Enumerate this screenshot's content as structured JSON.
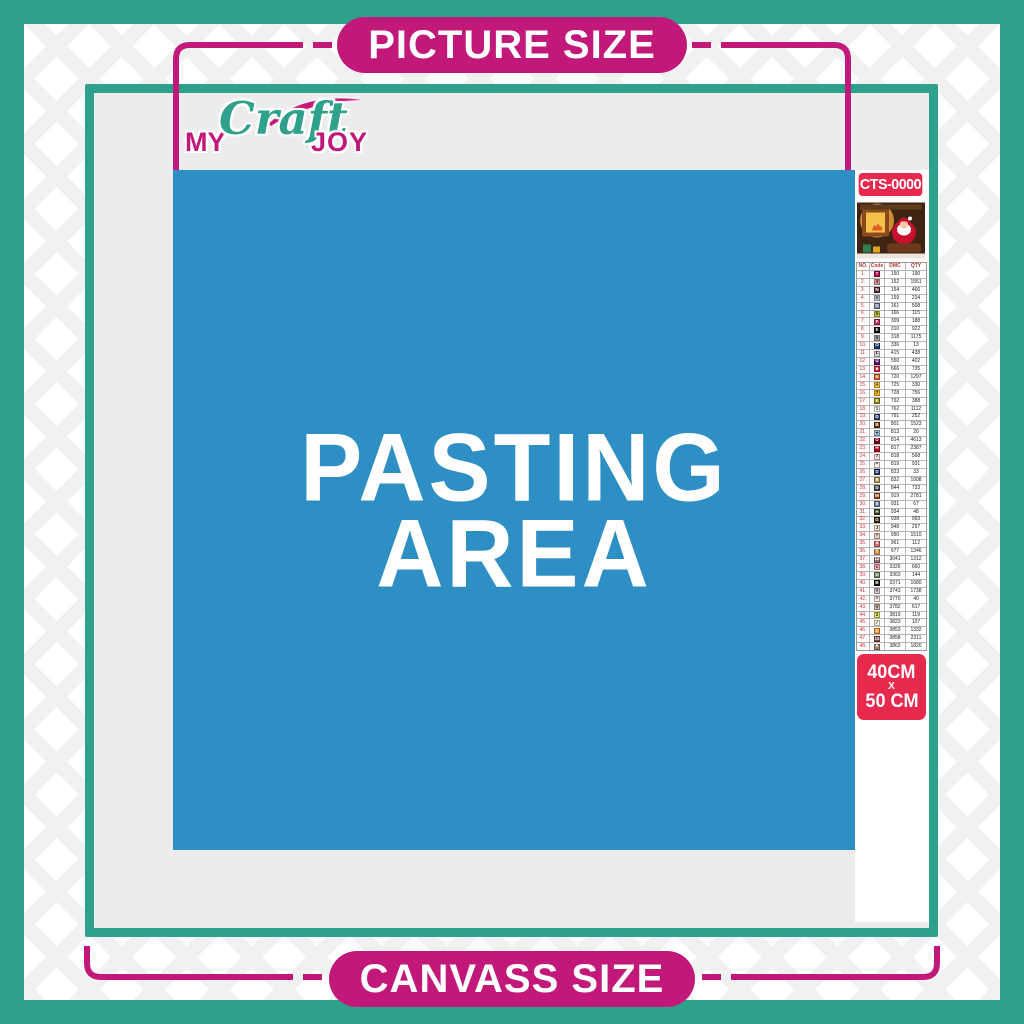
{
  "banners": {
    "top": "PICTURE SIZE",
    "bottom": "CANVASS SIZE"
  },
  "logo": {
    "part1": "MY",
    "part2": "Craft",
    "part3": "JOY"
  },
  "pasting_area": {
    "line1": "PASTING",
    "line2": "AREA"
  },
  "sidebar": {
    "sku": "CTS-0000",
    "thumbnail": "christmas-santa-scene",
    "size": {
      "line1": "40CM",
      "line2": "X",
      "line3": "50 CM"
    },
    "table": {
      "headers": [
        "NO.",
        "Code",
        "DMC",
        "QTY"
      ],
      "rows": [
        {
          "no": "1.",
          "sym": "T",
          "bg": "#AB0249",
          "fg": "#FFFFFF",
          "dmc": "150",
          "qty": "190"
        },
        {
          "no": "2.",
          "sym": "3",
          "bg": "#E2A099",
          "fg": "#222222",
          "dmc": "152",
          "qty": "1551"
        },
        {
          "no": "3.",
          "sym": "N",
          "bg": "#572433",
          "fg": "#FFFFFF",
          "dmc": "154",
          "qty": "466"
        },
        {
          "no": "4.",
          "sym": "X",
          "bg": "#C7CAD7",
          "fg": "#222222",
          "dmc": "159",
          "qty": "234"
        },
        {
          "no": "5.",
          "sym": "G",
          "bg": "#7880A4",
          "fg": "#FFFFFF",
          "dmc": "161",
          "qty": "508"
        },
        {
          "no": "6.",
          "sym": "h",
          "bg": "#C0C840",
          "fg": "#222222",
          "dmc": "166",
          "qty": "115"
        },
        {
          "no": "7.",
          "sym": "F",
          "bg": "#BA2B4E",
          "fg": "#FFFFFF",
          "dmc": "309",
          "qty": "188"
        },
        {
          "no": "8.",
          "sym": "E",
          "bg": "#000000",
          "fg": "#FFFFFF",
          "dmc": "310",
          "qty": "922"
        },
        {
          "no": "9.",
          "sym": "X",
          "bg": "#ABABAB",
          "fg": "#222222",
          "dmc": "318",
          "qty": "1175"
        },
        {
          "no": "10.",
          "sym": "O",
          "bg": "#253B73",
          "fg": "#FFFFFF",
          "dmc": "336",
          "qty": "13"
        },
        {
          "no": "11.",
          "sym": "L",
          "bg": "#D3D3D6",
          "fg": "#222222",
          "dmc": "415",
          "qty": "438"
        },
        {
          "no": "12.",
          "sym": "U",
          "bg": "#5C1869",
          "fg": "#FFFFFF",
          "dmc": "550",
          "qty": "402"
        },
        {
          "no": "13.",
          "sym": "■",
          "bg": "#E31D42",
          "fg": "#FFFFFF",
          "dmc": "666",
          "qty": "735"
        },
        {
          "no": "14.",
          "sym": "N",
          "bg": "#E55C1F",
          "fg": "#FFFFFF",
          "dmc": "720",
          "qty": "1297"
        },
        {
          "no": "15.",
          "sym": "A",
          "bg": "#FFC840",
          "fg": "#222222",
          "dmc": "725",
          "qty": "330"
        },
        {
          "no": "16.",
          "sym": "7",
          "bg": "#F6B728",
          "fg": "#222222",
          "dmc": "728",
          "qty": "756"
        },
        {
          "no": "17.",
          "sym": "E",
          "bg": "#948C10",
          "fg": "#FFFFFF",
          "dmc": "732",
          "qty": "388"
        },
        {
          "no": "18.",
          "sym": "1",
          "bg": "#FFFFFF",
          "fg": "#222222",
          "dmc": "762",
          "qty": "1112"
        },
        {
          "no": "19.",
          "sym": "D",
          "bg": "#3F4571",
          "fg": "#FFFFFF",
          "dmc": "791",
          "qty": "252"
        },
        {
          "no": "20.",
          "sym": "B",
          "bg": "#65350F",
          "fg": "#FFFFFF",
          "dmc": "801",
          "qty": "1523"
        },
        {
          "no": "21.",
          "sym": "●",
          "bg": "#A1C2D7",
          "fg": "#222222",
          "dmc": "813",
          "qty": "20"
        },
        {
          "no": "22.",
          "sym": "O",
          "bg": "#7B001B",
          "fg": "#FFFFFF",
          "dmc": "814",
          "qty": "4613"
        },
        {
          "no": "23.",
          "sym": "H",
          "bg": "#BB051F",
          "fg": "#FFFFFF",
          "dmc": "817",
          "qty": "2387"
        },
        {
          "no": "24.",
          "sym": "7",
          "bg": "#FFDFD9",
          "fg": "#222222",
          "dmc": "818",
          "qty": "568"
        },
        {
          "no": "25.",
          "sym": "+",
          "bg": "#FDEEEB",
          "fg": "#222222",
          "dmc": "819",
          "qty": "931"
        },
        {
          "no": "26.",
          "sym": "D",
          "bg": "#213063",
          "fg": "#FFFFFF",
          "dmc": "823",
          "qty": "33"
        },
        {
          "no": "27.",
          "sym": "8",
          "bg": "#BD9B51",
          "fg": "#FFFFFF",
          "dmc": "832",
          "qty": "1008"
        },
        {
          "no": "28.",
          "sym": "D",
          "bg": "#484848",
          "fg": "#FFFFFF",
          "dmc": "844",
          "qty": "733"
        },
        {
          "no": "29.",
          "sym": "M",
          "bg": "#A24510",
          "fg": "#FFFFFF",
          "dmc": "919",
          "qty": "2781"
        },
        {
          "no": "30.",
          "sym": "S",
          "bg": "#6A859E",
          "fg": "#FFFFFF",
          "dmc": "931",
          "qty": "67"
        },
        {
          "no": "31.",
          "sym": "H",
          "bg": "#313919",
          "fg": "#FFFFFF",
          "dmc": "934",
          "qty": "48"
        },
        {
          "no": "32.",
          "sym": "G",
          "bg": "#36220C",
          "fg": "#FFFFFF",
          "dmc": "938",
          "qty": "993"
        },
        {
          "no": "33.",
          "sym": "J",
          "bg": "#FEE7DA",
          "fg": "#222222",
          "dmc": "948",
          "qty": "297"
        },
        {
          "no": "34.",
          "sym": "*",
          "bg": "#EECFBC",
          "fg": "#222222",
          "dmc": "950",
          "qty": "1510"
        },
        {
          "no": "35.",
          "sym": "4",
          "bg": "#CF7375",
          "fg": "#FFFFFF",
          "dmc": "961",
          "qty": "112"
        },
        {
          "no": "36.",
          "sym": "T",
          "bg": "#DC9C56",
          "fg": "#FFFFFF",
          "dmc": "977",
          "qty": "1346"
        },
        {
          "no": "37.",
          "sym": "12",
          "bg": "#956F7C",
          "fg": "#FFFFFF",
          "dmc": "3041",
          "qty": "1312"
        },
        {
          "no": "38.",
          "sym": "c",
          "bg": "#FBADB4",
          "fg": "#222222",
          "dmc": "3326",
          "qty": "660"
        },
        {
          "no": "39.",
          "sym": "U",
          "bg": "#728256",
          "fg": "#FFFFFF",
          "dmc": "3363",
          "qty": "144"
        },
        {
          "no": "40.",
          "sym": "B",
          "bg": "#1E1108",
          "fg": "#FFFFFF",
          "dmc": "3371",
          "qty": "1680"
        },
        {
          "no": "41.",
          "sym": "Y",
          "bg": "#D7CBD3",
          "fg": "#222222",
          "dmc": "3743",
          "qty": "1738"
        },
        {
          "no": "42.",
          "sym": "^",
          "bg": "#FFEEE3",
          "fg": "#222222",
          "dmc": "3770",
          "qty": "40"
        },
        {
          "no": "43.",
          "sym": "V",
          "bg": "#D2BCA6",
          "fg": "#222222",
          "dmc": "3782",
          "qty": "617"
        },
        {
          "no": "44.",
          "sym": "2",
          "bg": "#E0E868",
          "fg": "#222222",
          "dmc": "3819",
          "qty": "119"
        },
        {
          "no": "45.",
          "sym": "✓",
          "bg": "#FFFDE3",
          "fg": "#222222",
          "dmc": "3823",
          "qty": "107"
        },
        {
          "no": "46.",
          "sym": "C",
          "bg": "#F79735",
          "fg": "#FFFFFF",
          "dmc": "3853",
          "qty": "1332"
        },
        {
          "no": "47.",
          "sym": "13",
          "bg": "#824D4D",
          "fg": "#FFFFFF",
          "dmc": "3858",
          "qty": "2311"
        },
        {
          "no": "48.",
          "sym": "A",
          "bg": "#A4846B",
          "fg": "#FFFFFF",
          "dmc": "3863",
          "qty": "1820"
        }
      ]
    }
  },
  "colors": {
    "teal": "#2EA18C",
    "magenta": "#C2187A",
    "pasting_blue": "#2E8FC4",
    "badge_red": "#E8294E",
    "canvas_gray": "#ECECEC"
  }
}
